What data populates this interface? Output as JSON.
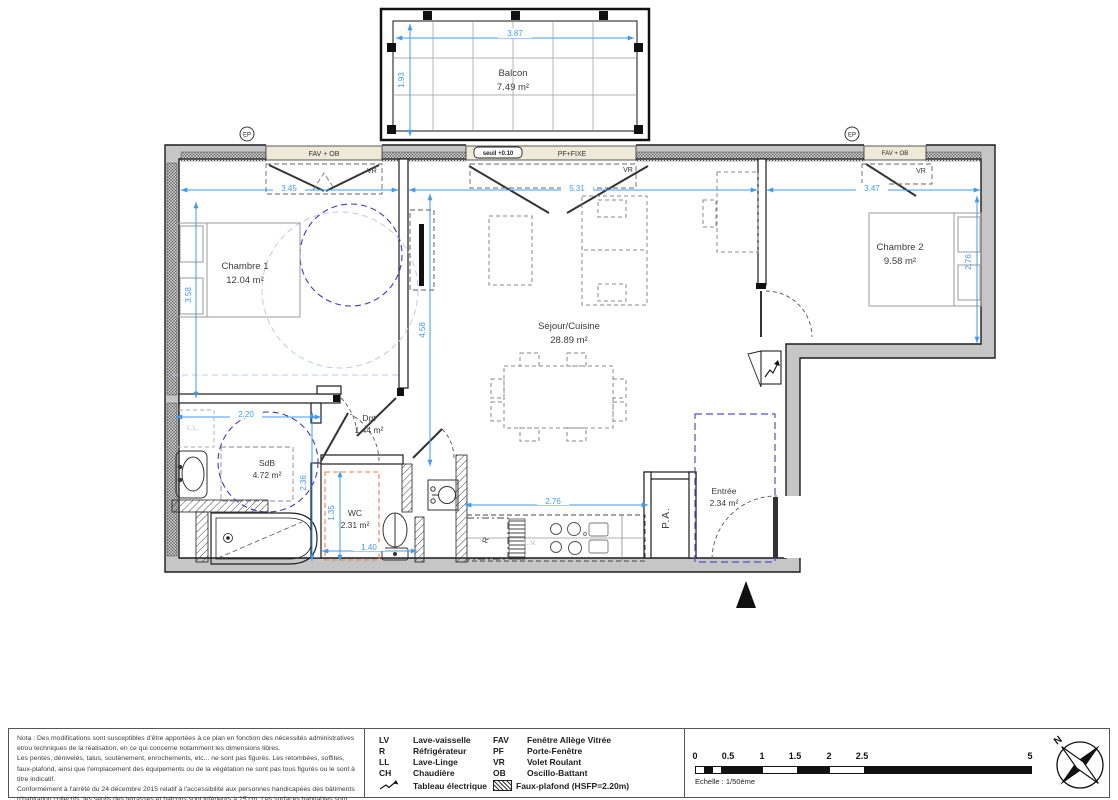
{
  "plan": {
    "rooms": {
      "balcon": {
        "name": "Balcon",
        "area": "7.49 m²"
      },
      "chambre1": {
        "name": "Chambre 1",
        "area": "12.04 m²"
      },
      "chambre2": {
        "name": "Chambre 2",
        "area": "9.58 m²"
      },
      "sejour": {
        "name": "Séjour/Cuisine",
        "area": "28.89 m²"
      },
      "sdb": {
        "name": "SdB",
        "area": "4.72 m²"
      },
      "wc": {
        "name": "WC",
        "area": "2.31 m²"
      },
      "dgt": {
        "name": "Dgt",
        "area": "1.44 m²"
      },
      "entree": {
        "name": "Entrée",
        "area": "2.34 m²"
      }
    },
    "dims": {
      "balcon_width": "3.87",
      "balcon_depth": "1.93",
      "chambre1_top": "3.45",
      "sejour_top": "5.31",
      "chambre2_top": "3.47",
      "chambre1_left": "3.58",
      "sejour_left": "4.58",
      "chambre2_right": "2.76",
      "sdb_top": "2.20",
      "sdb_right": "2.36",
      "wc_left": "1.35",
      "wc_bottom": "1.40",
      "cuisine_bottom": "2.76"
    },
    "labels": {
      "seuil": "seuil +0.10",
      "pf_fixe": "PF+FIXE",
      "fav_ob": "FAV + OB",
      "vr": "VR",
      "ep": "EP",
      "ll": "L.L.",
      "lv": "L.V.",
      "r": "R",
      "pa": "P.A."
    }
  },
  "footer": {
    "nota": [
      "Nota : Des modifications sont susceptibles d'être apportées à ce plan en fonction des nécessités administratives et/ou techniques de la réalisation, en ce qui concerne notamment les dimensions libres.",
      "Les pentes, dénivelés, talus, soutènement, enrochements, etc... ne sont pas figurés. Les retombées, soffites, faux-plafond, ainsi que l'emplacement des équipements ou de la végétation ne sont pas tous figurés ou le sont à titre indicatif.",
      "Conformément à l'arrêté du 24 décembre 2015 relatif à l'accessibilité aux personnes handicapées des bâtiments d'habitation collectifs, les seuils des terrasses et balcons sont inférieurs à 25 cm. Les surfaces habitables sont conformes au décret du 23 mai 1997 (art. 112.2)."
    ],
    "legend": [
      {
        "abbr": "LV",
        "label": "Lave-vaisselle"
      },
      {
        "abbr": "R",
        "label": "Réfrigérateur"
      },
      {
        "abbr": "LL",
        "label": "Lave-Linge"
      },
      {
        "abbr": "CH",
        "label": "Chaudière"
      },
      {
        "abbr": "",
        "label": "Tableau électrique"
      },
      {
        "abbr": "FAV",
        "label": "Fenêtre Allège Vitrée"
      },
      {
        "abbr": "PF",
        "label": "Porte-Fenêtre"
      },
      {
        "abbr": "VR",
        "label": "Volet Roulant"
      },
      {
        "abbr": "OB",
        "label": "Oscillo-Battant"
      },
      {
        "abbr": "",
        "label": "Faux-plafond (HSFP=2.20m)"
      }
    ],
    "scale": {
      "ticks": [
        "0",
        "0.5",
        "1",
        "1.5",
        "2",
        "2.5",
        "5"
      ],
      "caption": "Echelle : 1/50ème"
    },
    "north": "N"
  },
  "colors": {
    "dimension_blue": "#3f9bf0",
    "accessibility_blue": "#3b3bbf",
    "faux_plafond_blue": "#5050c8",
    "faux_plafond_orange": "#e8824a",
    "wall_gray": "#c6c6c6",
    "sill_beige": "#efe9d8"
  }
}
